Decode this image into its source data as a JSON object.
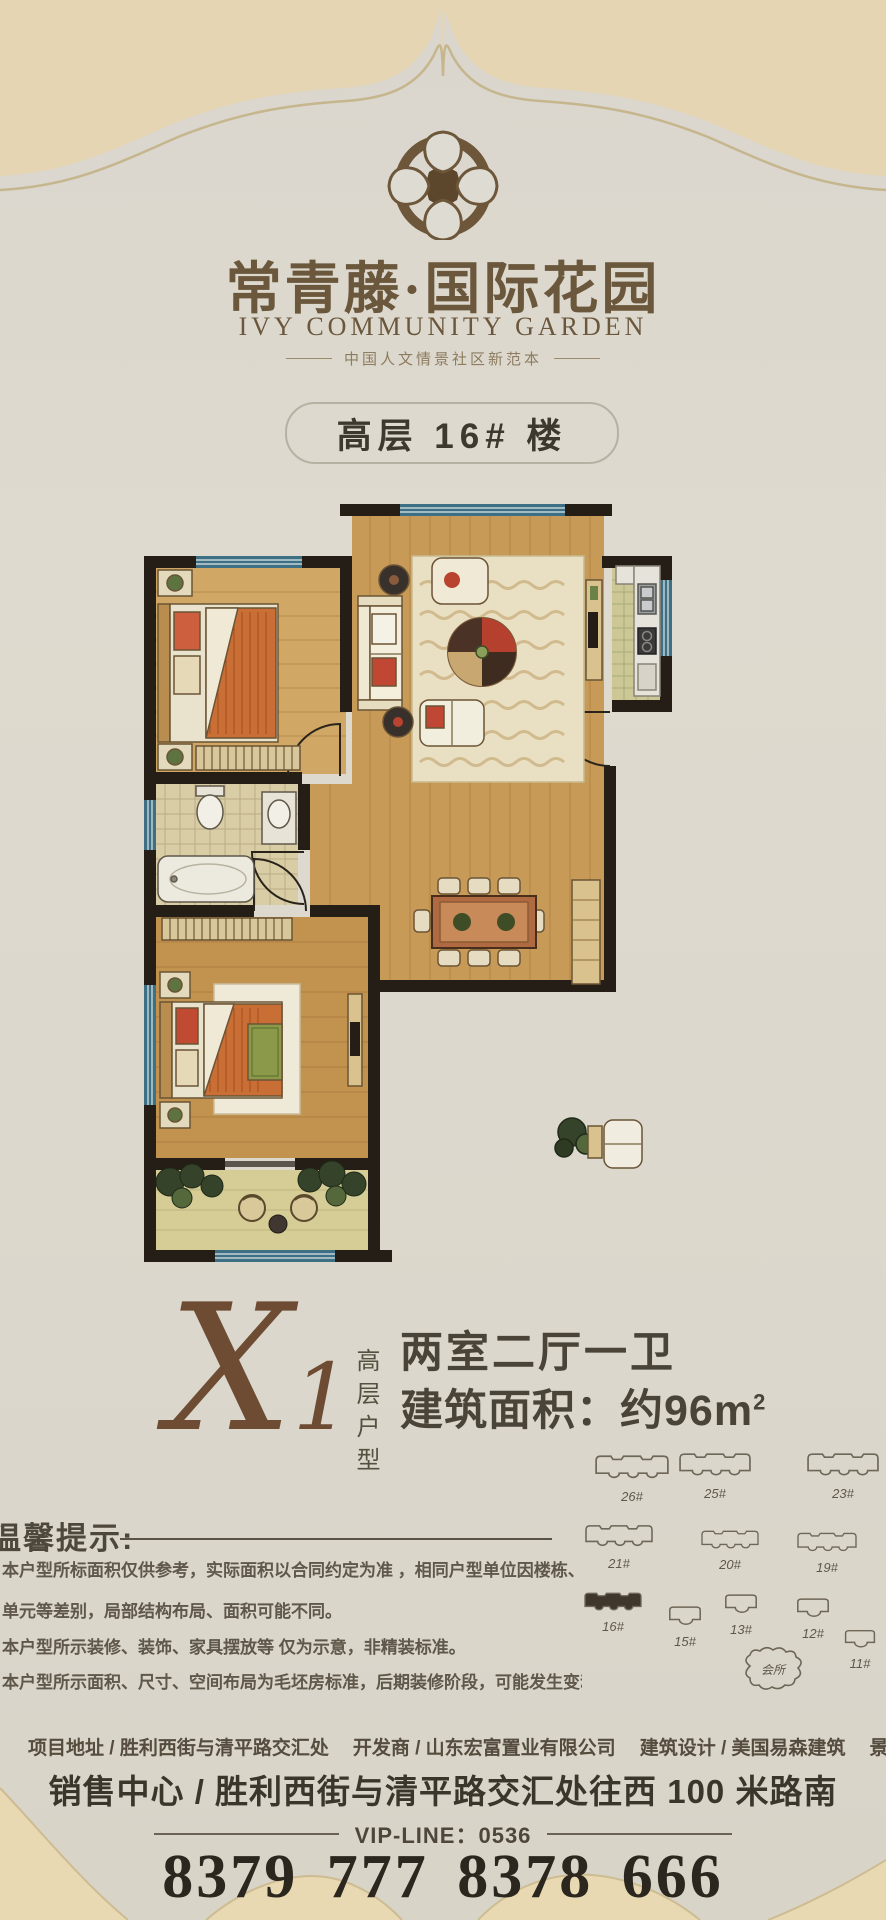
{
  "brand": {
    "title": "常青藤·国际花园",
    "subtitle": "IVY COMMUNITY GARDEN",
    "tagline": "中国人文情景社区新范本"
  },
  "badge": {
    "label": "高层 16# 楼"
  },
  "unit": {
    "code": "X1",
    "category": "高层户型",
    "rooms": "两室二厅一卫",
    "area_prefix": "建筑面积：约96m",
    "area_sup": "2"
  },
  "tips": {
    "heading": "温馨提示:",
    "lines": [
      "本户型所标面积仅供参考，实际面积以合同约定为准 ，相同户型单位因楼栋、楼层、",
      "单元等差别，局部结构布局、面积可能不同。",
      "本户型所示装修、装饰、家具摆放等 仅为示意，非精装标准。",
      "本户型所示面积、尺寸、空间布局为毛坯房标准，后期装修阶段，可能发生变动"
    ]
  },
  "site_plan": {
    "buildings": [
      {
        "label": "26#",
        "kind": "wide",
        "x": 594,
        "y": 1452,
        "w": 76,
        "filled": false
      },
      {
        "label": "25#",
        "kind": "wide",
        "x": 678,
        "y": 1450,
        "w": 74,
        "filled": false
      },
      {
        "label": "23#",
        "kind": "wide",
        "x": 806,
        "y": 1450,
        "w": 74,
        "filled": false
      },
      {
        "label": "21#",
        "kind": "wide",
        "x": 584,
        "y": 1522,
        "w": 70,
        "filled": false
      },
      {
        "label": "20#",
        "kind": "wide",
        "x": 700,
        "y": 1528,
        "w": 60,
        "filled": false
      },
      {
        "label": "19#",
        "kind": "wide",
        "x": 796,
        "y": 1530,
        "w": 62,
        "filled": false
      },
      {
        "label": "16#",
        "kind": "wide",
        "x": 583,
        "y": 1590,
        "w": 60,
        "filled": true
      },
      {
        "label": "15#",
        "kind": "small",
        "x": 666,
        "y": 1604,
        "w": 38,
        "filled": false
      },
      {
        "label": "13#",
        "kind": "small",
        "x": 722,
        "y": 1592,
        "w": 38,
        "filled": false
      },
      {
        "label": "12#",
        "kind": "small",
        "x": 794,
        "y": 1596,
        "w": 38,
        "filled": false
      },
      {
        "label": "11#",
        "kind": "small",
        "x": 842,
        "y": 1628,
        "w": 36,
        "filled": false
      },
      {
        "label": "会所",
        "kind": "club",
        "x": 738,
        "y": 1646,
        "w": 70,
        "filled": false
      }
    ]
  },
  "footer": {
    "info": [
      "项目地址 / 胜利西街与清平路交汇处",
      "开发商 / 山东宏富置业有限公司",
      "建筑设计 / 美国易森建筑",
      "景观设计 / 香港阿特贝尔"
    ],
    "sales_center": "销售中心 / 胜利西街与清平路交汇处往西 100 米路南",
    "vip_line": "VIP-LINE：0536",
    "phone": "8379 777  8378 666"
  },
  "colors": {
    "band": "#e5d5b2",
    "band_line": "#c6b68d",
    "accent_brown": "#6d5639",
    "wall": "#241e17",
    "window": "#3e7085",
    "wood": "#c89a58",
    "highlight_building": "#3f372b"
  }
}
